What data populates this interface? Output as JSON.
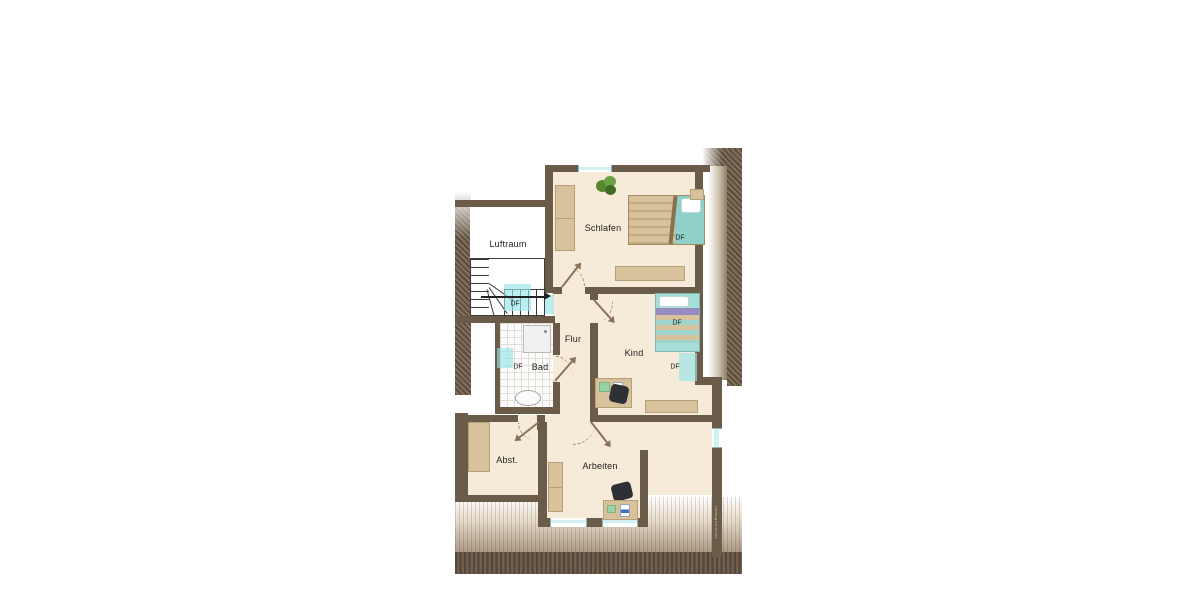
{
  "plan": {
    "type": "floor-plan-upper-storey",
    "rooms": [
      {
        "name": "luftraum",
        "label": "Luftraum"
      },
      {
        "name": "schlafen",
        "label": "Schlafen"
      },
      {
        "name": "flur",
        "label": "Flur"
      },
      {
        "name": "kind",
        "label": "Kind"
      },
      {
        "name": "bad",
        "label": "Bad"
      },
      {
        "name": "abstellraum",
        "label": "Abst."
      },
      {
        "name": "arbeiten",
        "label": "Arbeiten"
      }
    ],
    "roof_windows": [
      {
        "location": "stairs",
        "label": "DF"
      },
      {
        "location": "bad",
        "label": "DF"
      },
      {
        "location": "schlafen",
        "label": "DF"
      },
      {
        "location": "kind-upper",
        "label": "DF"
      },
      {
        "location": "kind-lower",
        "label": "DF"
      }
    ],
    "watermark": "Immogrundriss",
    "colors": {
      "wall": "#6a5c49",
      "floor": "#f6ead8",
      "furniture": "#d8c29b",
      "window_glass": "#d2f1f2",
      "roof_hatch": "#7b6b55",
      "bed_teal": "#8fd0c9",
      "pillow_purple": "#968bc1",
      "plant_green": "#55872f",
      "chair_dark": "#2f2f36"
    }
  }
}
